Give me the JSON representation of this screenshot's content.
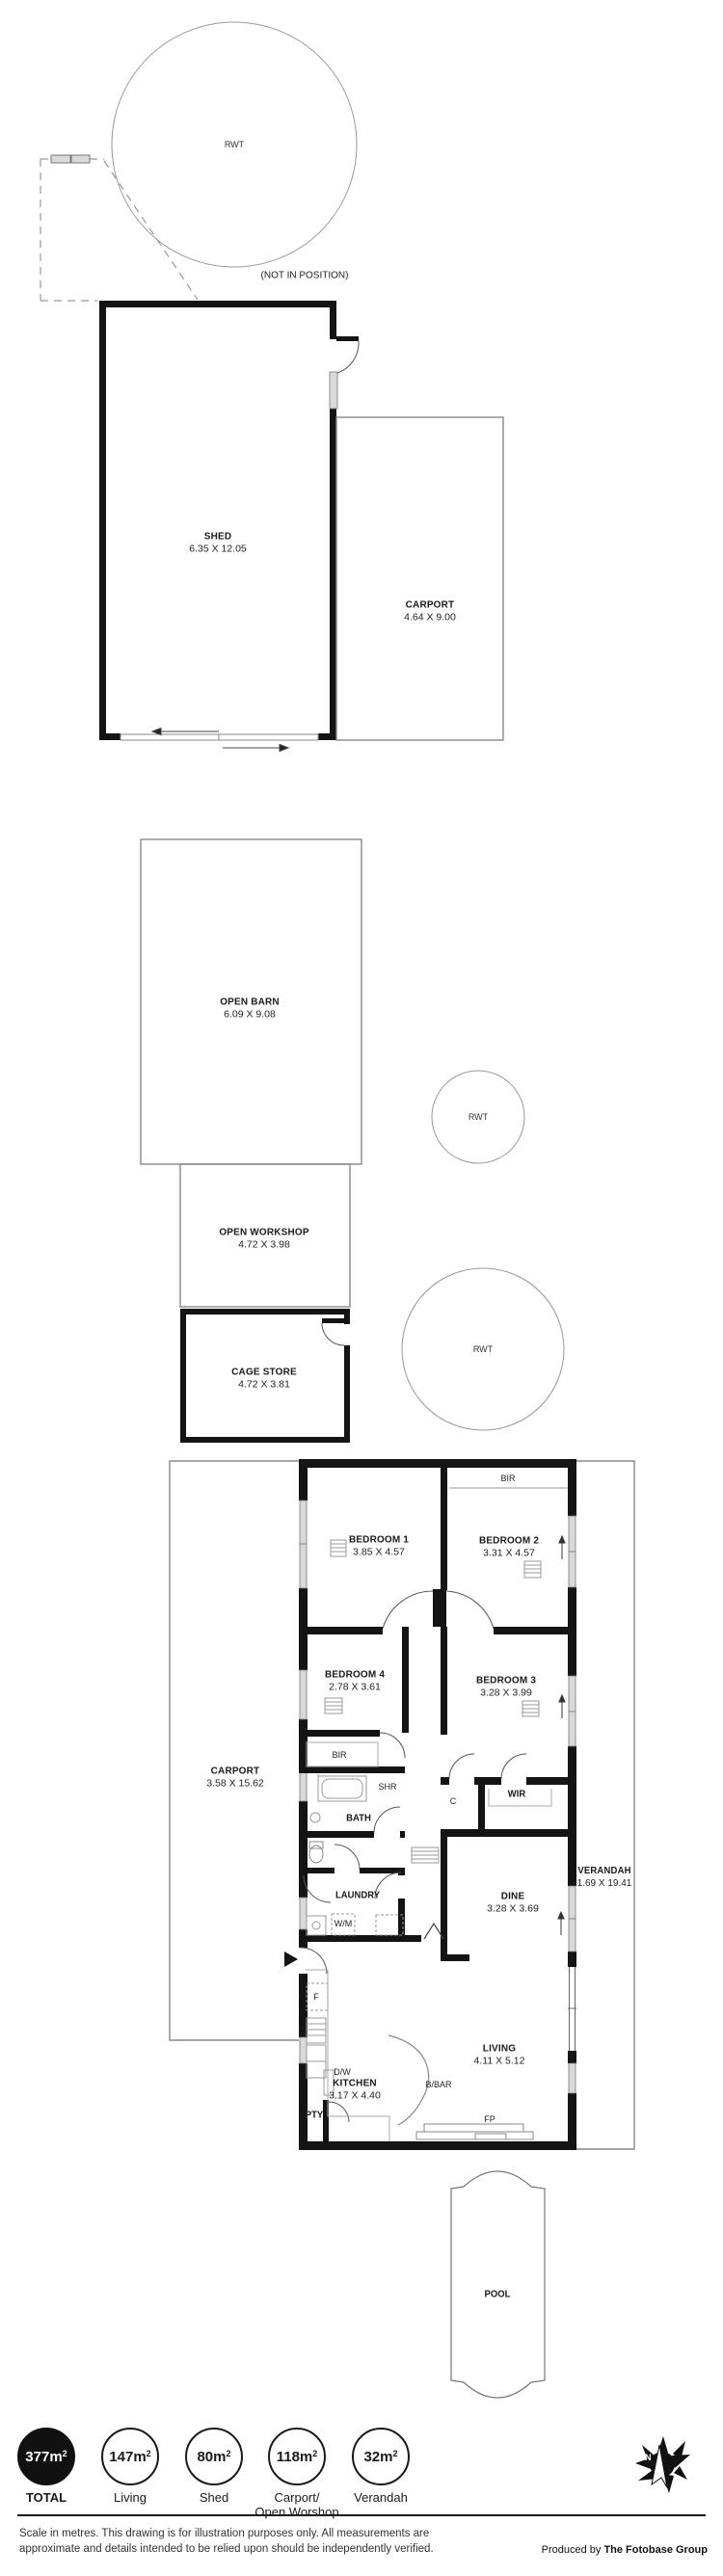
{
  "plan": {
    "rwt": "RWT",
    "not_in_position": "(NOT IN POSITION)",
    "shed": {
      "name": "SHED",
      "dims": "6.35 X 12.05"
    },
    "shed_carport": {
      "name": "CARPORT",
      "dims": "4.64 X 9.00"
    },
    "open_barn": {
      "name": "OPEN BARN",
      "dims": "6.09 X 9.08"
    },
    "open_workshop": {
      "name": "OPEN WORKSHOP",
      "dims": "4.72 X 3.98"
    },
    "cage_store": {
      "name": "CAGE STORE",
      "dims": "4.72 X 3.81"
    },
    "house": {
      "carport": {
        "name": "CARPORT",
        "dims": "3.58 X 15.62"
      },
      "bedroom1": {
        "name": "BEDROOM 1",
        "dims": "3.85 X 4.57"
      },
      "bedroom2": {
        "name": "BEDROOM 2",
        "dims": "3.31 X 4.57"
      },
      "bedroom3": {
        "name": "BEDROOM 3",
        "dims": "3.28 X 3.99"
      },
      "bedroom4": {
        "name": "BEDROOM 4",
        "dims": "2.78 X 3.61"
      },
      "bir": "BIR",
      "shr": "SHR",
      "bath": "BATH",
      "wir": "WIR",
      "cupboard": "C",
      "laundry": "LAUNDRY",
      "wm": "W/M",
      "dine": {
        "name": "DINE",
        "dims": "3.28 X 3.69"
      },
      "living": {
        "name": "LIVING",
        "dims": "4.11 X 5.12"
      },
      "kitchen": {
        "name": "KITCHEN",
        "dims": "3.17 X 4.40"
      },
      "pty": "PTY",
      "fridge": "F",
      "dw": "D/W",
      "bbar": "B/BAR",
      "fp": "FP",
      "verandah": {
        "name": "VERANDAH",
        "dims": "1.69 X 19.41"
      }
    },
    "pool": "POOL"
  },
  "legend": {
    "items": [
      {
        "value": "377m",
        "sup": "2",
        "label": "TOTAL"
      },
      {
        "value": "147m",
        "sup": "2",
        "label": "Living"
      },
      {
        "value": "80m",
        "sup": "2",
        "label": "Shed"
      },
      {
        "value": "118m",
        "sup": "2",
        "label": "Carport/\nOpen Worshop"
      },
      {
        "value": "32m",
        "sup": "2",
        "label": "Verandah"
      }
    ]
  },
  "compass": {
    "north": "N"
  },
  "footer": {
    "disclaimer_line1": "Scale in metres. This drawing is for illustration purposes only. All measurements are",
    "disclaimer_line2": "approximate and details intended to be relied upon should be independently verified.",
    "produced_by_prefix": "Produced by ",
    "produced_by_brand": "The Fotobase Group"
  }
}
